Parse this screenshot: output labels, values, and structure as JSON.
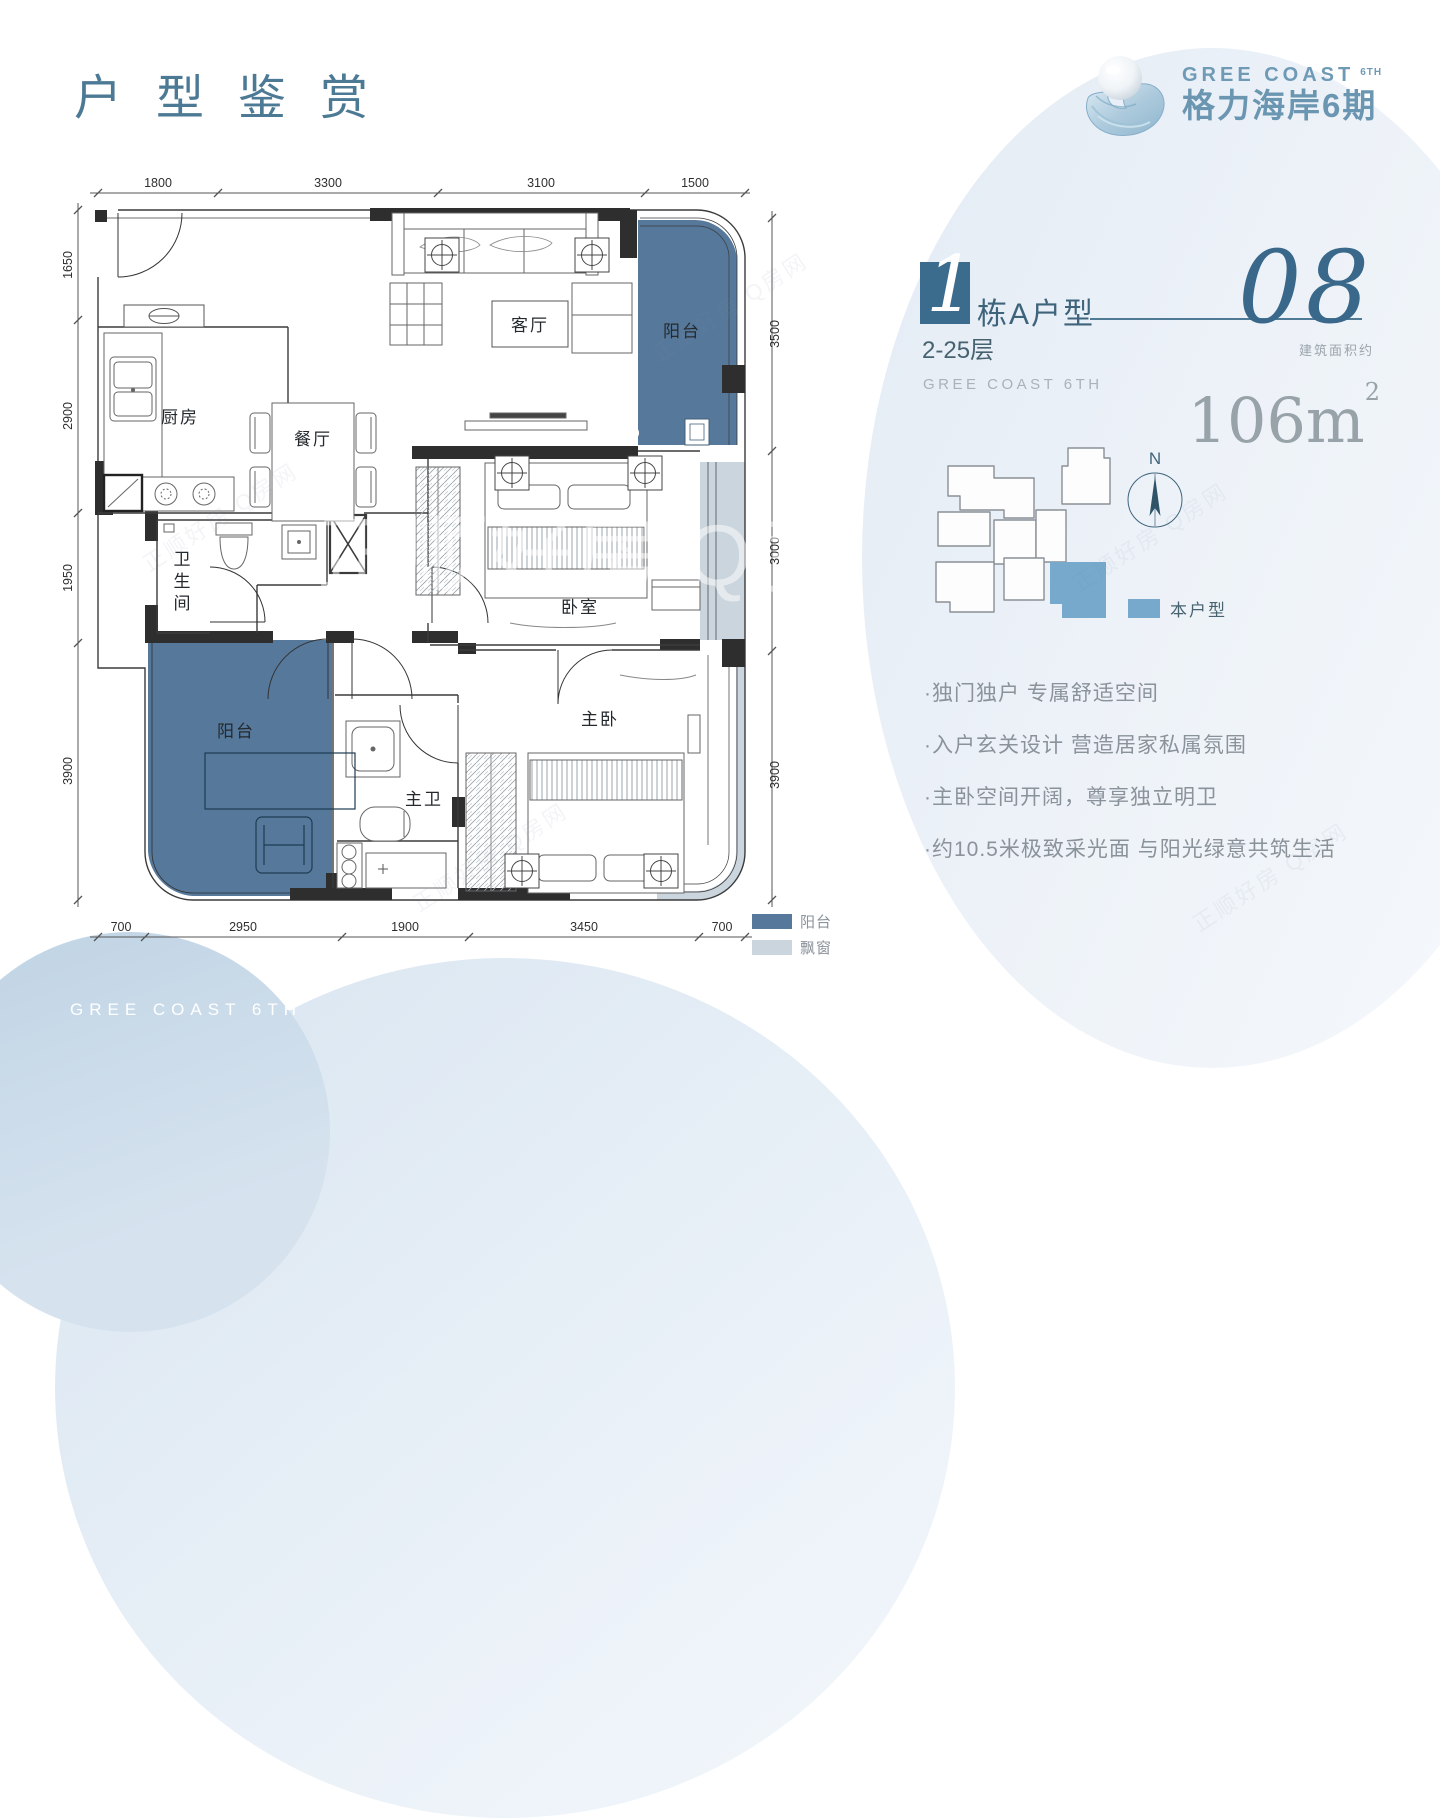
{
  "page": {
    "title": "户型鉴赏",
    "footer_brand": "GREE COAST 6TH",
    "watermark": "正顺好房 Q房网"
  },
  "logo": {
    "en": "GREE COAST",
    "phase": "6TH",
    "cn": "格力海岸6期"
  },
  "unit_header": {
    "block_number": "1",
    "block_type": "栋A户型",
    "unit_number": "08",
    "floors": "2-25层",
    "brand": "GREE COAST 6TH",
    "area_prefix": "建筑面积约",
    "area_value": "106m",
    "area_unit_sup": "2"
  },
  "site_plan": {
    "north": "N",
    "legend": "本户型",
    "highlight_color": "#76A9CB"
  },
  "features": [
    "·独门独户 专属舒适空间",
    "·入户玄关设计 营造居家私属氛围",
    "·主卧空间开阔，尊享独立明卫",
    "·约10.5米极致采光面 与阳光绿意共筑生活"
  ],
  "floor_plan": {
    "rooms": {
      "kitchen": "厨房",
      "dining": "餐厅",
      "living": "客厅",
      "balcony_top": "阳台",
      "balcony_bottom": "阳台",
      "bath_chars": [
        "卫",
        "生",
        "间"
      ],
      "bedroom": "卧室",
      "master_bedroom": "主卧",
      "master_bath": "主卫"
    },
    "dims": {
      "top": [
        "1800",
        "3300",
        "3100",
        "1500"
      ],
      "left": [
        "1650",
        "2900",
        "1950",
        "3900"
      ],
      "right": [
        "3500",
        "3000",
        "3900"
      ],
      "bottom": [
        "700",
        "2950",
        "1900",
        "3450",
        "700"
      ]
    },
    "legend": [
      {
        "label": "阳台",
        "color": "#56789B"
      },
      {
        "label": "飘窗",
        "color": "#CBD5DD"
      }
    ]
  },
  "colors": {
    "accent_teal": "#4C7A95",
    "deep_teal": "#3A688A",
    "balcony": "#56789B",
    "bay_window": "#CBD5DD",
    "highlight_unit": "#76A9CB"
  }
}
